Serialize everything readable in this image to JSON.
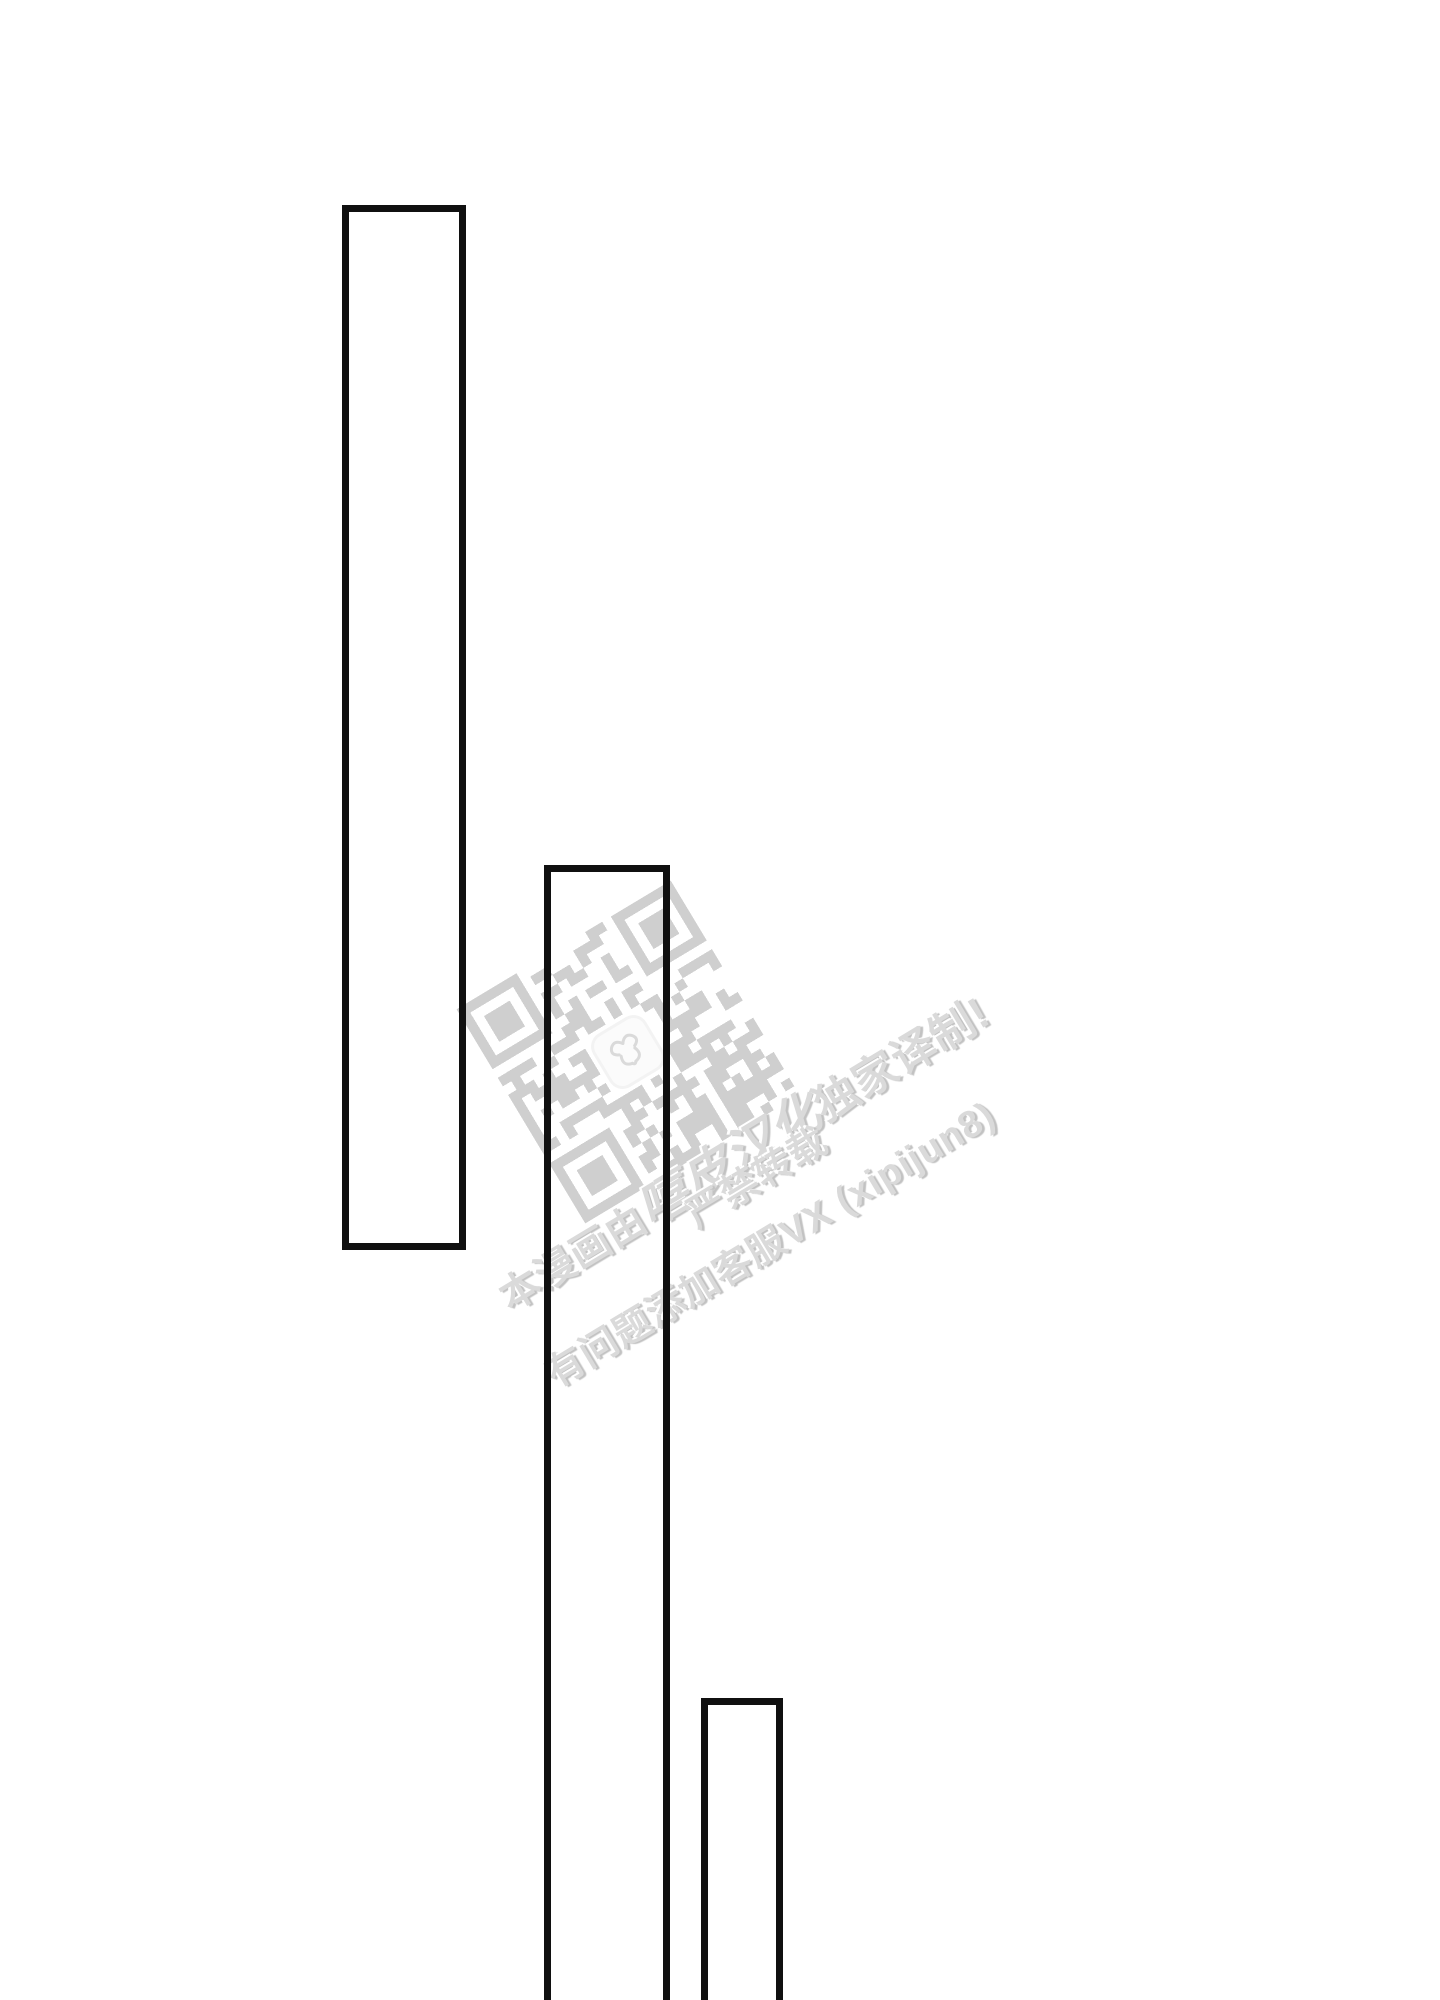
{
  "page": {
    "background_color": "#ffffff",
    "panel_border_color": "#101010"
  },
  "watermark": {
    "rotation_deg": -31,
    "text_color": "#dadada",
    "qr_module_color": "#cdcdcd",
    "qr_icon": "qr-code-icon",
    "logo_icon": "flower-logo-icon",
    "line1_prefix": "本漫画由",
    "line1_group": "嘻皮汉化",
    "line1_suffix": "独家译制!",
    "line2": "严禁转载",
    "line3": "有问题添加客服VX (xipijun8)"
  }
}
